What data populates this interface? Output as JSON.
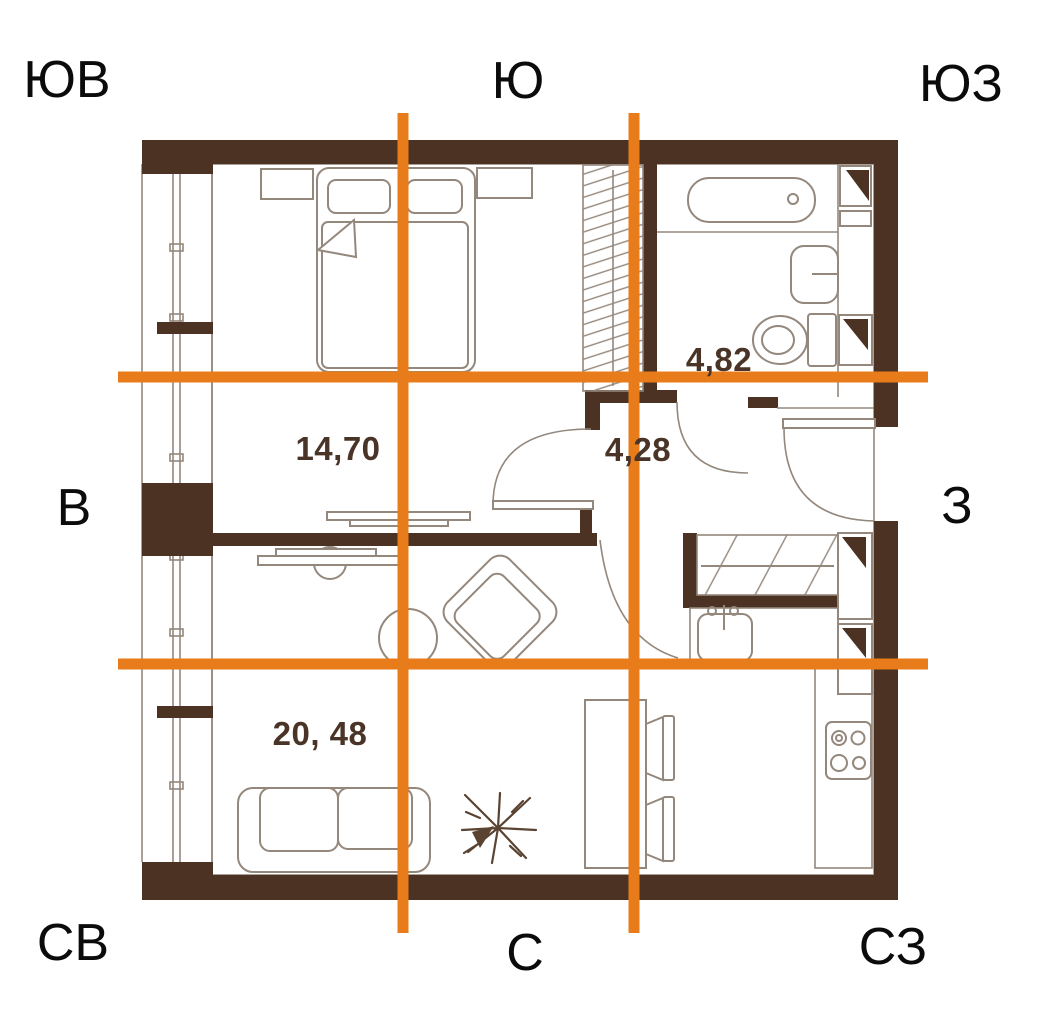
{
  "title": "apartment-floor-plan-with-compass-grid",
  "compass": {
    "top_left": "ЮВ",
    "top_center": "Ю",
    "top_right": "ЮЗ",
    "mid_left": "В",
    "mid_right": "З",
    "bottom_left": "СВ",
    "bottom_center": "С",
    "bottom_right": "СЗ"
  },
  "rooms": {
    "bedroom": {
      "area": "14,70"
    },
    "bathroom": {
      "area": "4,82"
    },
    "hallway": {
      "area": "4,28"
    },
    "living_kitchen": {
      "area": "20, 48"
    }
  },
  "colors": {
    "wall": "#4b3222",
    "accent_orange": "#e87c1a",
    "furniture_line": "#94877c",
    "area_label": "#4a3427",
    "compass_text": "#0b0b0b",
    "plant": "#5b4332",
    "background": "#ffffff"
  }
}
